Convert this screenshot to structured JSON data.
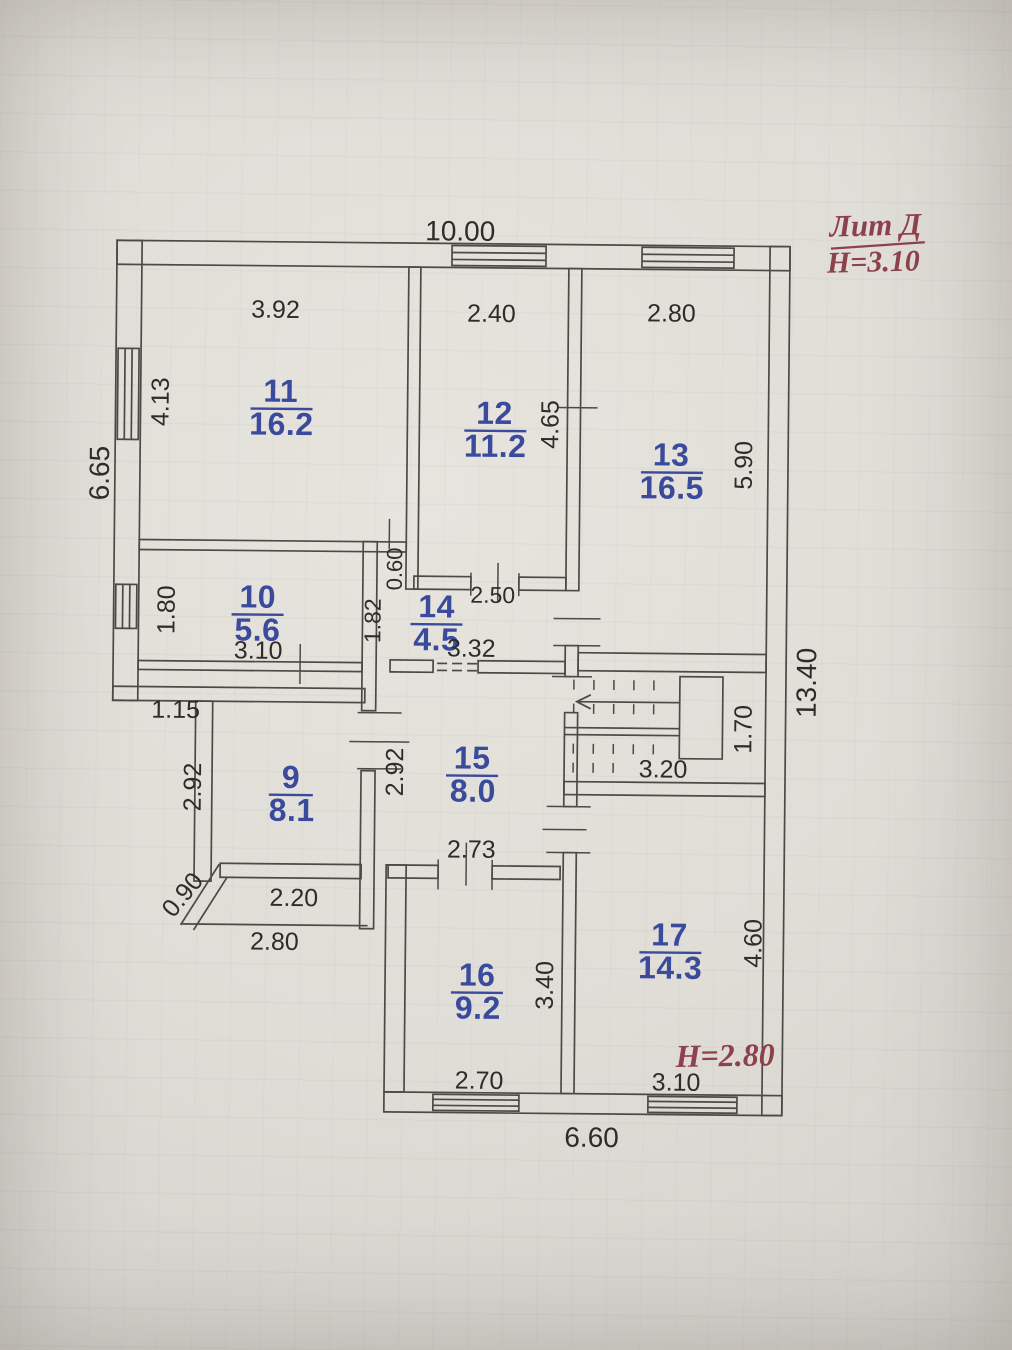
{
  "title_block": {
    "litera": "Лит Д",
    "floor_height": "H=3.10"
  },
  "secondary_floor_height": "H=2.80",
  "overall_dimensions": {
    "top": "10.00",
    "left": "6.65",
    "right": "13.40",
    "bottom": "6.60"
  },
  "rooms": [
    {
      "number": "11",
      "area": "16.2",
      "width": "3.92",
      "height": "4.13"
    },
    {
      "number": "12",
      "area": "11.2",
      "width": "2.40",
      "height": "4.65",
      "lower_width": "2.50"
    },
    {
      "number": "13",
      "area": "16.5",
      "width": "2.80",
      "height": "5.90"
    },
    {
      "number": "10",
      "area": "5.6",
      "width": "3.10",
      "height": "1.80"
    },
    {
      "number": "14",
      "area": "4.5",
      "width": "3.32",
      "height": "1.82",
      "wall_jog": "0.60"
    },
    {
      "number": "9",
      "area": "8.1",
      "width": "2.20",
      "height": "2.92",
      "chamfer": "0.90",
      "outer_width": "2.80",
      "entry_offset": "1.15"
    },
    {
      "number": "15",
      "area": "8.0",
      "width": "2.73",
      "height": "2.92"
    },
    {
      "number": "16",
      "area": "9.2",
      "width": "2.70",
      "height": "3.40"
    },
    {
      "number": "17",
      "area": "14.3",
      "width": "3.10",
      "height": "4.60"
    }
  ],
  "stairs": {
    "width": "3.20",
    "landing_depth": "1.70"
  },
  "colors": {
    "room_label": "#3a4a9c",
    "dimension": "#2e2c29",
    "annotation": "#8d414b",
    "line": "#4c4a46"
  }
}
